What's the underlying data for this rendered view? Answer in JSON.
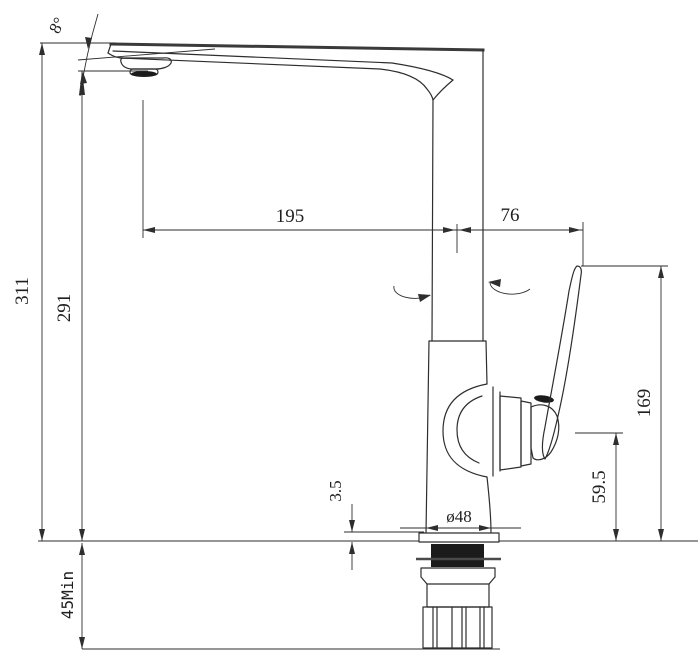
{
  "drawing": {
    "kind": "technical-dimension-drawing",
    "subject": "kitchen faucet side elevation with installation dimensions",
    "units": "mm",
    "colors": {
      "line": "#2e2e2e",
      "text": "#1f1f1f",
      "background": "#ffffff"
    },
    "dimensions": {
      "spout_angle": {
        "label": "8°",
        "value": 8,
        "unit": "deg",
        "orientation": "angular"
      },
      "spout_reach": {
        "label": "195",
        "value": 195,
        "unit": "mm",
        "orientation": "horizontal"
      },
      "spout_to_handle": {
        "label": "76",
        "value": 76,
        "unit": "mm",
        "orientation": "horizontal"
      },
      "overall_height": {
        "label": "311",
        "value": 311,
        "unit": "mm",
        "orientation": "vertical"
      },
      "outlet_height": {
        "label": "291",
        "value": 291,
        "unit": "mm",
        "orientation": "vertical"
      },
      "handle_top_height": {
        "label": "169",
        "value": 169,
        "unit": "mm",
        "orientation": "vertical"
      },
      "body_height": {
        "label": "59.5",
        "value": 59.5,
        "unit": "mm",
        "orientation": "vertical"
      },
      "plate_thickness": {
        "label": "3.5",
        "value": 3.5,
        "unit": "mm",
        "orientation": "vertical"
      },
      "base_diameter": {
        "label": "ø48",
        "value": 48,
        "unit": "mm",
        "orientation": "diameter"
      },
      "under_counter_min": {
        "label": "45Min",
        "value": 45,
        "unit": "mm",
        "qualifier": "Min",
        "orientation": "vertical"
      }
    }
  }
}
